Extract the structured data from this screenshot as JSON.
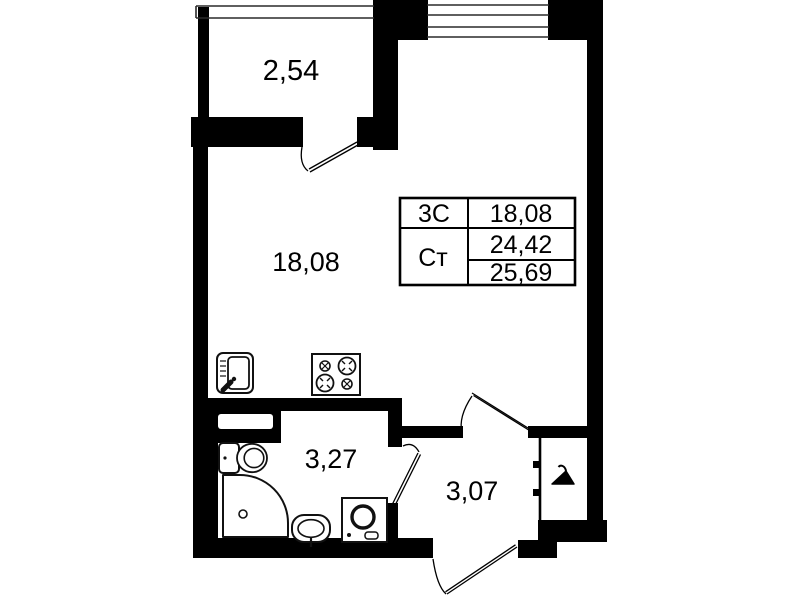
{
  "document": {
    "kind": "apartment-floor-plan"
  },
  "rooms": [
    {
      "name": "balcony",
      "area": "2,54"
    },
    {
      "name": "living-room",
      "area": "18,08"
    },
    {
      "name": "bathroom",
      "area": "3,27"
    },
    {
      "name": "hallway",
      "area": "3,07"
    }
  ],
  "info_table": {
    "rows": [
      {
        "label": "3С",
        "values": [
          "18,08"
        ]
      },
      {
        "label": "Ст",
        "values": [
          "24,42",
          "25,69"
        ]
      }
    ]
  },
  "icons": {
    "kitchen_sink": "kitchen-sink-icon",
    "stove": "stove-icon",
    "toilet": "toilet-icon",
    "shower": "shower-icon",
    "washbasin": "washbasin-icon",
    "washing_machine": "washing-machine-icon",
    "hanger": "hanger-icon"
  },
  "colors": {
    "wall": "#000000",
    "background": "#ffffff",
    "fixture_stroke": "#111111"
  }
}
